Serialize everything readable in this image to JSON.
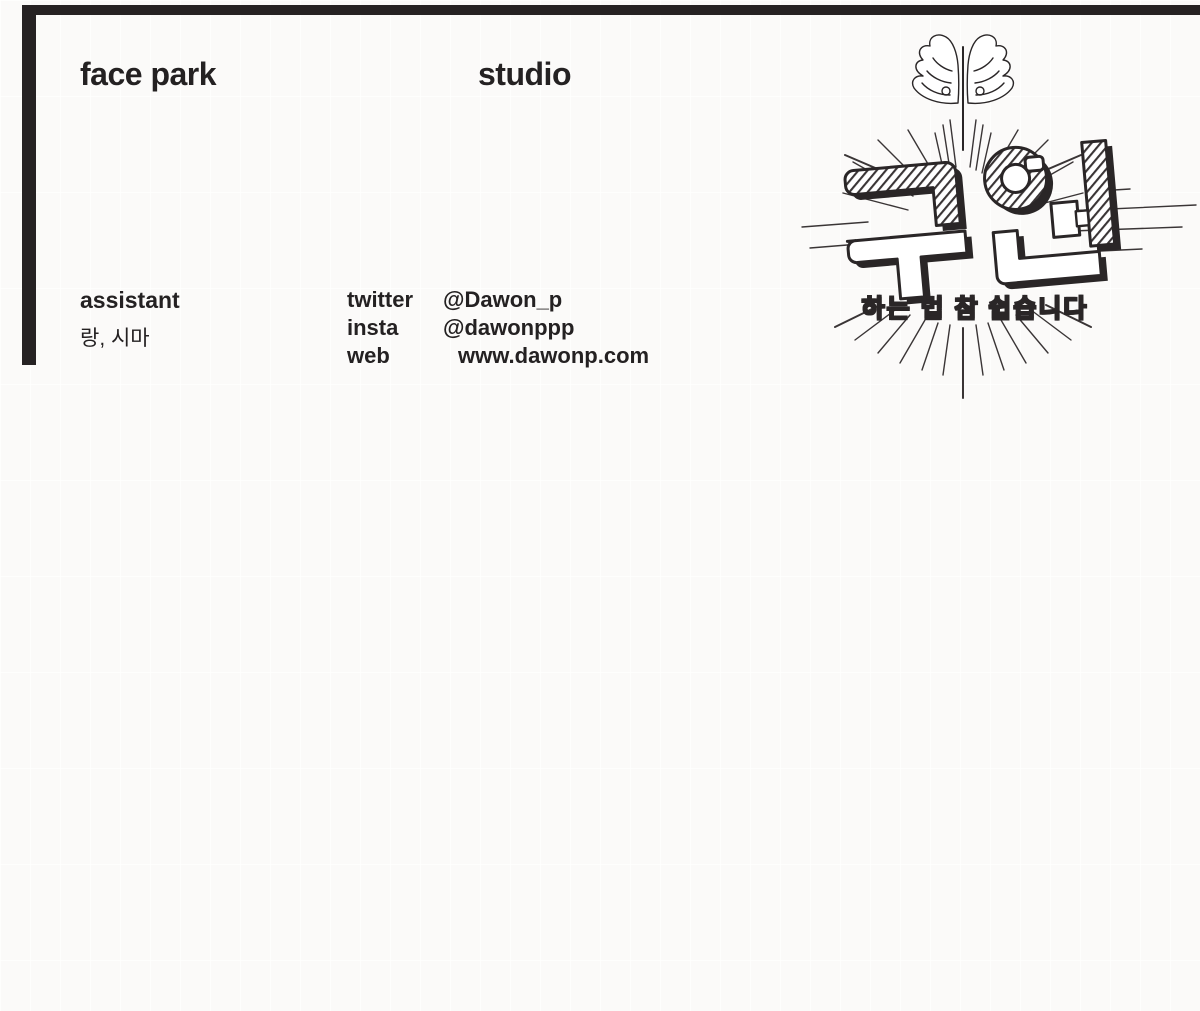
{
  "page": {
    "background": "#fbfaf9",
    "ink": "#262223"
  },
  "header": {
    "studio_left": "face park",
    "studio_right": "studio"
  },
  "credits": {
    "assistant_label": "assistant",
    "assistant_names": "랑, 시마"
  },
  "contacts": {
    "rows": [
      {
        "label": "twitter",
        "value": "@Dawon_p"
      },
      {
        "label": "insta",
        "value": "@dawonppp"
      },
      {
        "label": "web",
        "value": "www.dawonp.com"
      }
    ]
  },
  "logo": {
    "title": "구원",
    "subtitle": "하는 법 참 쉽습니다",
    "icons": [
      "wings-icon",
      "sunburst-rays"
    ]
  }
}
